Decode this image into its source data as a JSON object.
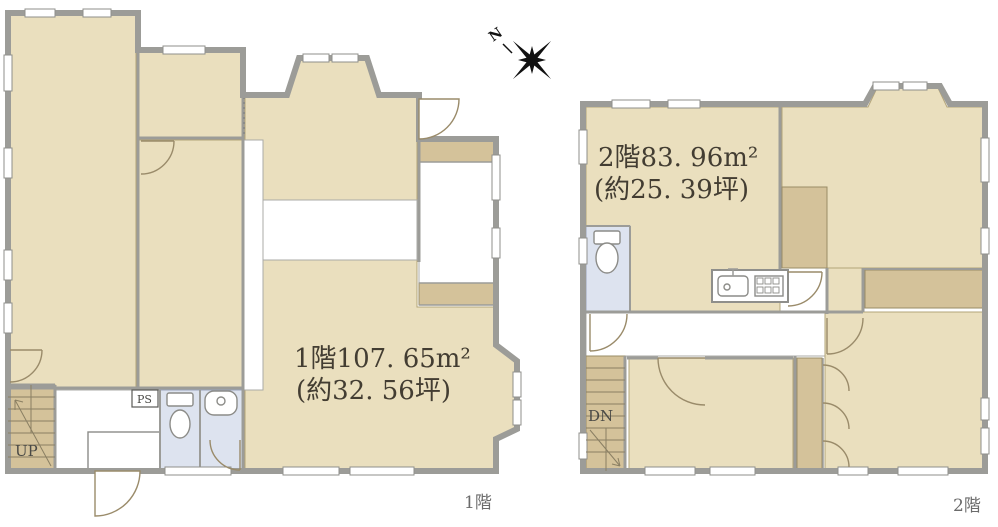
{
  "document": {
    "type": "real-estate-floor-plan"
  },
  "colors": {
    "room_fill": "#EADFBE",
    "closet_fill": "#D4C29A",
    "wall_gray": "#9C9C98",
    "wet_area_blue": "#DDE3EF",
    "text_dark": "#433D32",
    "label_gray": "#6B6B6B"
  },
  "compass": {
    "north_label": "N"
  },
  "floor1": {
    "floor_label": "1階",
    "area_line1": "1階107. 65m²",
    "area_line2": "(約32. 56坪)",
    "stairs_label": "UP",
    "shaft_label": "PS"
  },
  "floor2": {
    "floor_label": "2階",
    "area_line1": "2階83. 96m²",
    "area_line2": "(約25. 39坪)",
    "stairs_label": "DN"
  }
}
